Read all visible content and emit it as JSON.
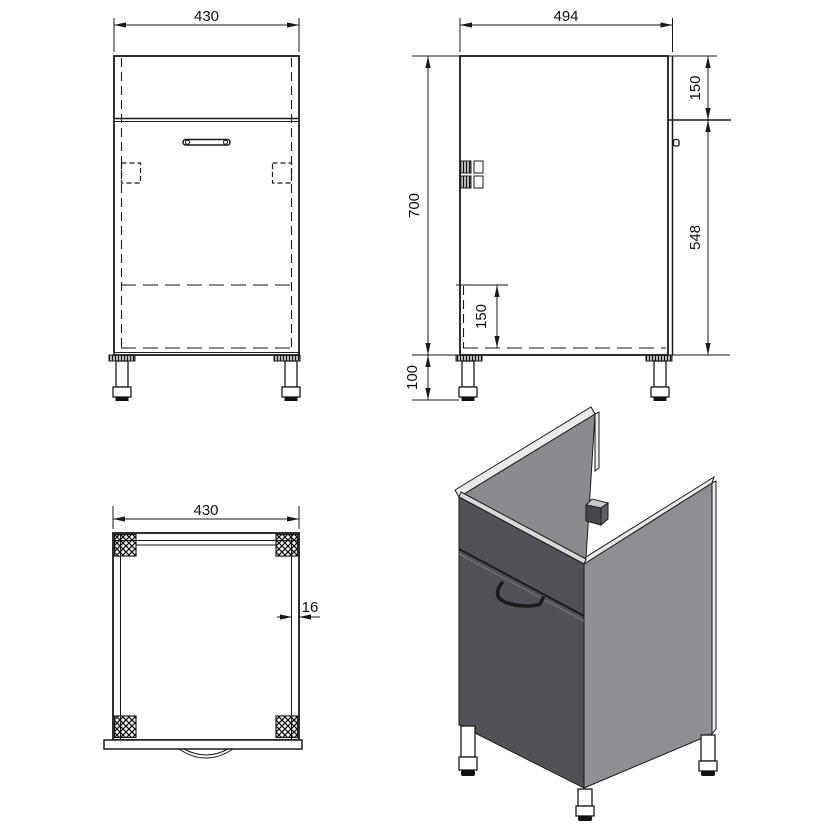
{
  "drawing": {
    "views": {
      "front": {
        "width_mm": "430"
      },
      "side": {
        "depth_mm": "494",
        "height_mm": "700",
        "top_section_mm": "150",
        "front_lower_mm": "548",
        "shelf_offset_mm": "150",
        "legs_mm": "100"
      },
      "top": {
        "width_mm": "430",
        "panel_thickness_mm": "16"
      }
    },
    "colors": {
      "line": "#1a1a1a",
      "front_face": "#515257",
      "side_face": "#8E8F93",
      "inner_face": "#8A8B8F",
      "edge_bevel": "#E9EAEC",
      "front_bevel": "#D7D8DA",
      "clip_top": "#C8C9CB",
      "clip_front": "#46474B",
      "clip_side": "#606166",
      "leg": "#ffffff",
      "foot": "#111111"
    }
  }
}
